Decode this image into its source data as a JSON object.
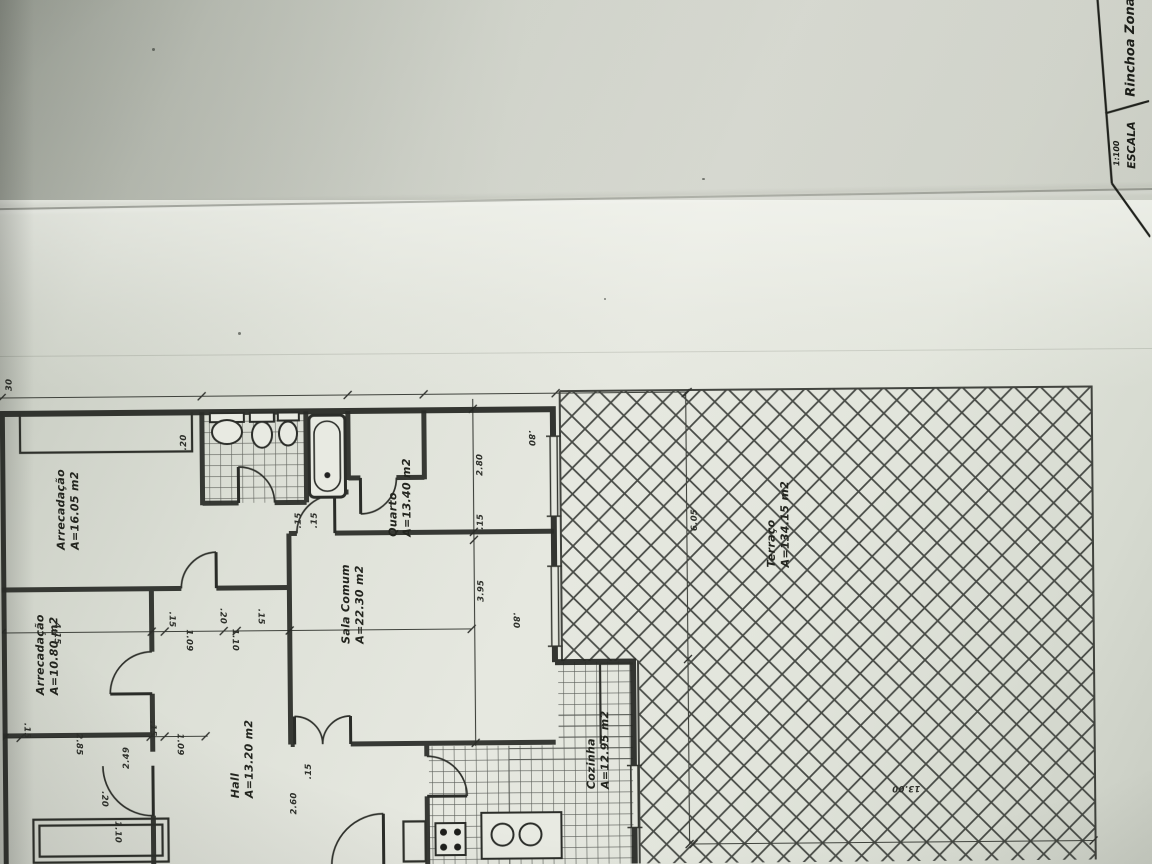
{
  "title_block": {
    "project_name": "Rinchoa Zona",
    "scale_label": "ESCALA",
    "scale_value": "1:100"
  },
  "rooms": [
    {
      "name": "Arrecadação",
      "area": "A=16.05 m2"
    },
    {
      "name": "Arrecadação",
      "area": "A=10.80 m2"
    },
    {
      "name": "Quarto",
      "area": "A=13.40 m2"
    },
    {
      "name": "Sala Comum",
      "area": "A=22.30 m2"
    },
    {
      "name": "Hall",
      "area": "A=13.20 m2"
    },
    {
      "name": "Cozinha",
      "area": "A=12.95 m2"
    },
    {
      "name": "Terraço",
      "area": "A=134.15 m2"
    }
  ],
  "dims": [
    "30",
    ".20",
    ".15",
    ".15",
    "2.80",
    ".15",
    "3.95",
    ".80",
    ".80",
    "6.05",
    "4.15",
    "2.85",
    ".15",
    ".15",
    "1.09",
    ".15",
    "1.09",
    ".20",
    "1.10",
    ".15",
    "2.49",
    "2.60",
    ".15",
    "13.00",
    ".20",
    "1.10"
  ],
  "colors": {
    "ink": "#262824",
    "paper": "#e6e8e0"
  }
}
